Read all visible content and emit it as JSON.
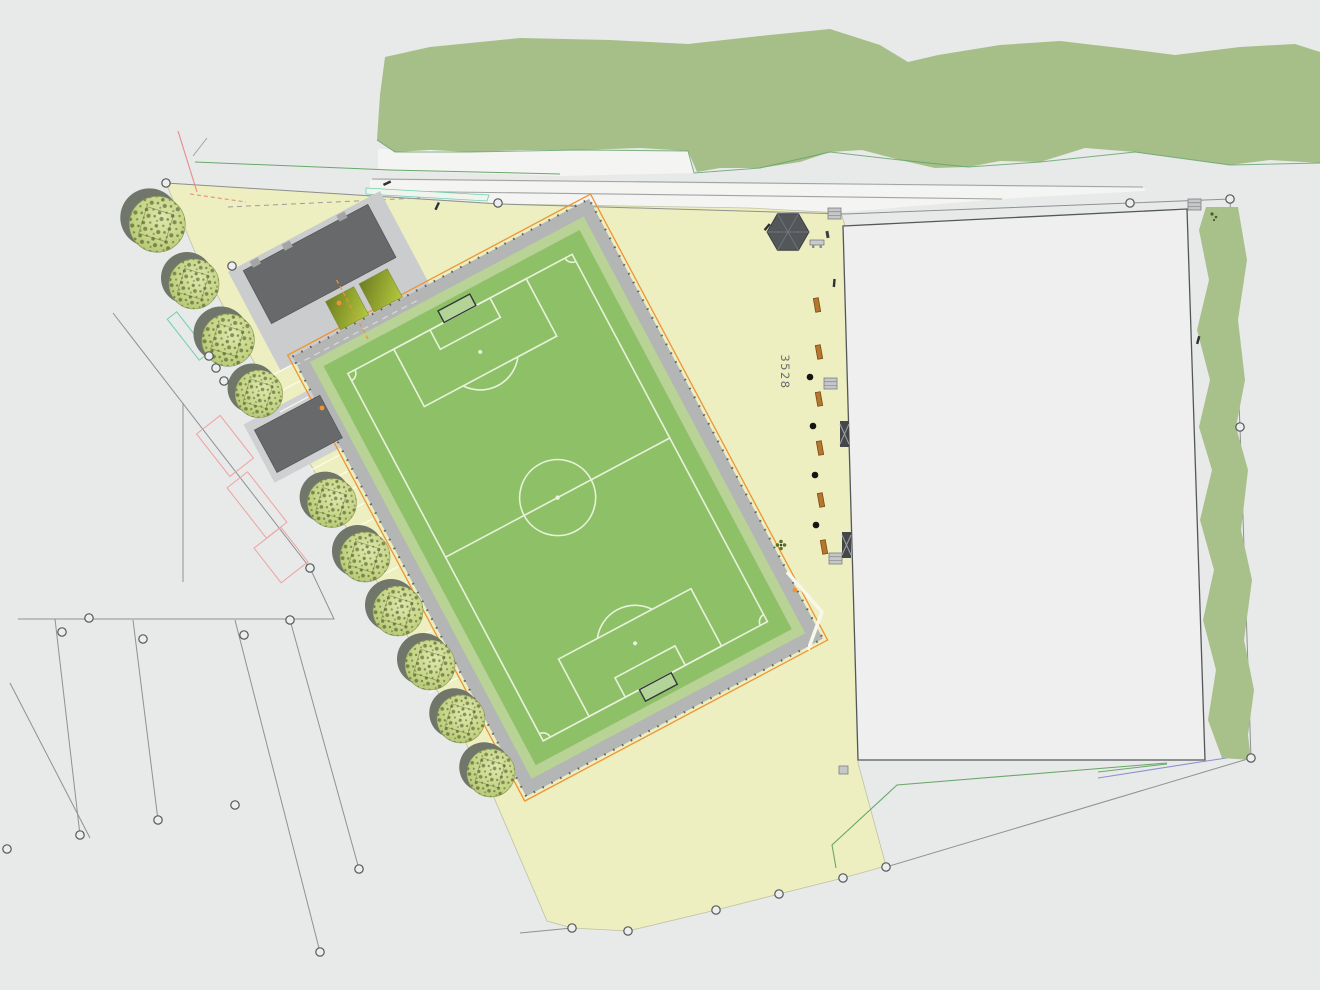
{
  "meta": {
    "drawing_type": "landscape-site-plan",
    "canvas": {
      "width": 1320,
      "height": 990
    }
  },
  "labels": {
    "parcel_number": "3528"
  },
  "palette": {
    "background": "#e8e9e9",
    "road_fill": "#f4f4f2",
    "road_line": "#a2a3a3",
    "forest": "#a6bf88",
    "ground_yellow": "#edefc0",
    "pitch_turf": "#8ec167",
    "pitch_margin": "#b9d295",
    "pitch_lines": "#e9f2dc",
    "path_gray": "#b4b6b6",
    "roof_gray": "#67696b",
    "apron_gray": "#cbcccd",
    "parcel_fill": "#efeff0",
    "parcel_border": "#54575a",
    "hedge_strip": "#a8c18a",
    "orange_accent": "#ee9434",
    "bench_wood": "#b5772e",
    "tree_canopy": "#c3d488",
    "survey_line": "#8f9192",
    "demolition_pink": "#eda3a3",
    "stakeout_teal": "#6fd0b0",
    "utility_purple": "#8a8fd0",
    "utility_green": "#6aa86a"
  },
  "inventory": {
    "trees_along_drive": 10,
    "benches": 6,
    "planting_dots": 4,
    "survey_markers": 28,
    "pavilion": "hexagonal shelter",
    "buildings": [
      "clubhouse with dark roof",
      "storage building"
    ],
    "pitch": "rotated football pitch with full markings",
    "parking": "angled stall striping along south-west path"
  }
}
